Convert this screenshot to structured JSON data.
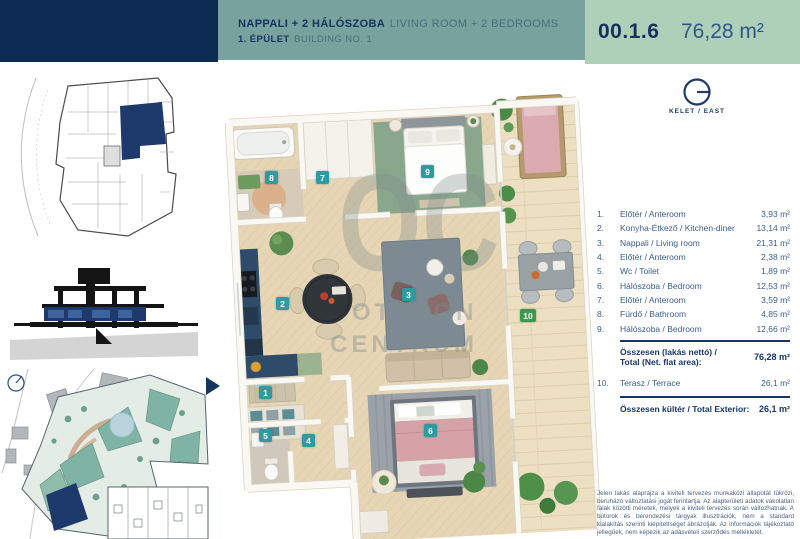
{
  "header": {
    "title_hu": "NAPPALI + 2 HÁLÓSZOBA",
    "title_en": "LIVING ROOM + 2 BEDROOMS",
    "subtitle_hu": "1. ÉPÜLET",
    "subtitle_en": "BUILDING NO. 1",
    "unit_id": "00.1.6",
    "unit_area": "76,28 m²"
  },
  "compass": {
    "label": "KELET / EAST"
  },
  "badges": [
    "1",
    "2",
    "3",
    "4",
    "5",
    "6",
    "7",
    "8",
    "9",
    "10"
  ],
  "watermark": {
    "monogram": "OC",
    "line1": "OTTHON",
    "line2": "CENTRUM"
  },
  "rooms": [
    {
      "num": "1.",
      "name": "Előtér / Anteroom",
      "area": "3,93 m²"
    },
    {
      "num": "2.",
      "name": "Konyha-Étkező / Kitchen-diner",
      "area": "13,14 m²"
    },
    {
      "num": "3.",
      "name": "Nappali / Living room",
      "area": "21,31 m²"
    },
    {
      "num": "4.",
      "name": "Előtér / Anteroom",
      "area": "2,38 m²"
    },
    {
      "num": "5.",
      "name": "Wc / Toilet",
      "area": "1,89 m²"
    },
    {
      "num": "6.",
      "name": "Hálószoba / Bedroom",
      "area": "12,53 m²"
    },
    {
      "num": "7.",
      "name": "Előtér / Anteroom",
      "area": "3,59 m²"
    },
    {
      "num": "8.",
      "name": "Fürdő / Bathroom",
      "area": "4,85 m²"
    },
    {
      "num": "9.",
      "name": "Hálószoba / Bedroom",
      "area": "12,66 m²"
    }
  ],
  "totals": {
    "net_label_line1": "Összesen (lakás nettó) /",
    "net_label_line2": "Total (Net. flat area):",
    "net_value": "76,28 m²",
    "exterior_row": {
      "num": "10.",
      "name": "Terasz / Terrace",
      "area": "26,1 m²"
    },
    "exterior_label": "Összesen kültér / Total Exterior:",
    "exterior_value": "26,1 m²"
  },
  "disclaimer": "Jelen lakás alaprajza a kiviteli tervezés munkaközi állapotát tükrözi, beruházó változtatási jogát fenntartja. Az alapterületi adatok vakolatlan falak közötti méretek, melyek a kiviteli tervezés során változhatnak. A bútorok és berendezési tárgyak illusztrációk, nem a standard kialakítás szerinti kiépítettséget ábrázolják. Az információk tájékoztató jellegűek, nem képezik az adásvételi szerződés mellékletét.",
  "colors": {
    "navy": "#0d2b52",
    "teal_band": "#78a29e",
    "green_band": "#aecfb8",
    "badge_teal": "#2f9aa0",
    "badge_green": "#3f9850",
    "table_text": "#3b5d92"
  }
}
